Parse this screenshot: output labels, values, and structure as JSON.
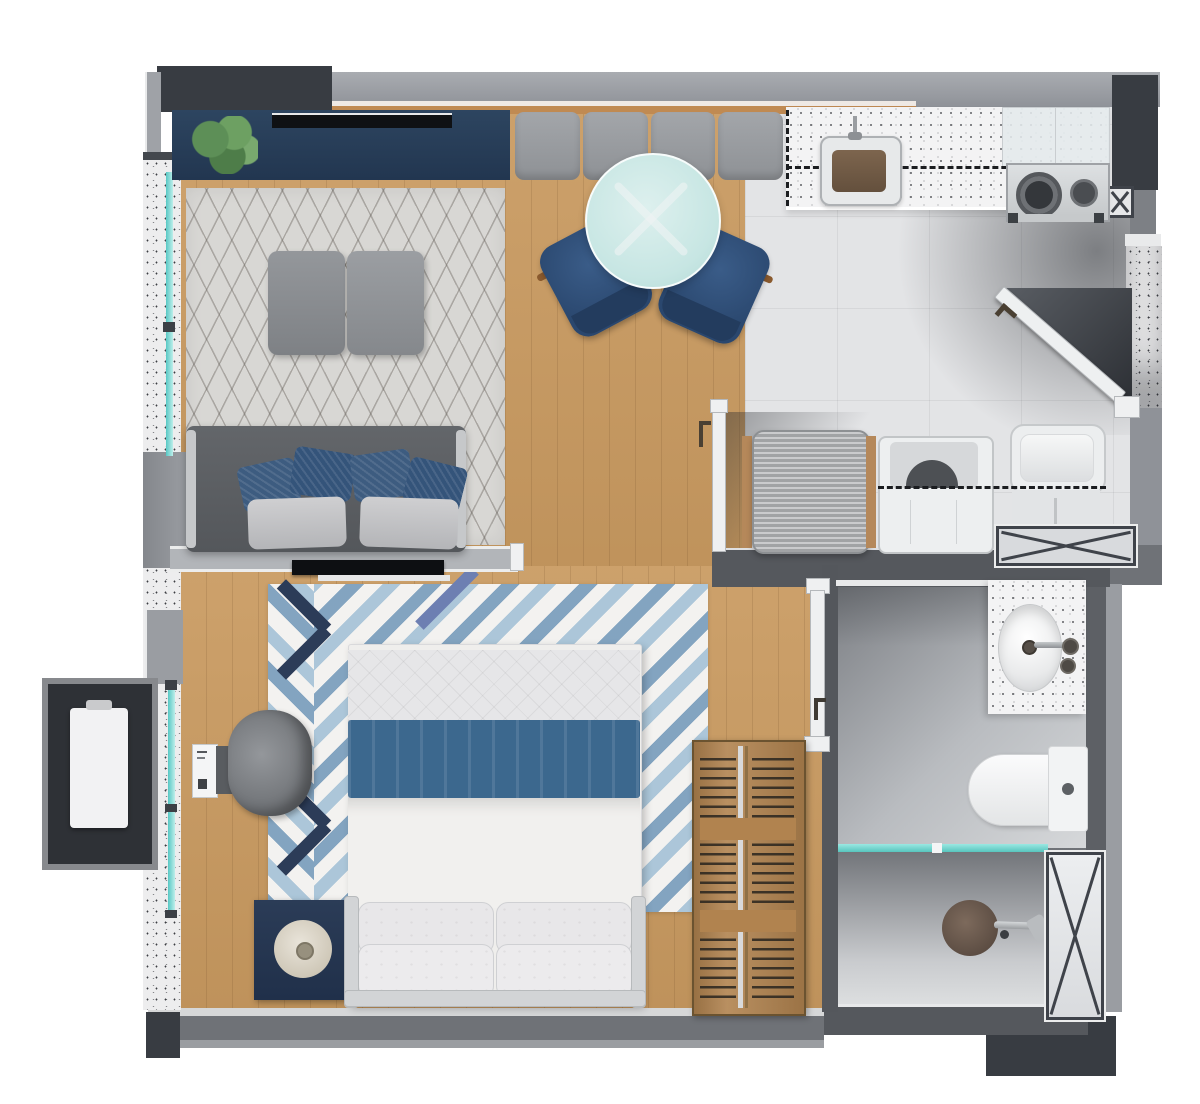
{
  "meta": {
    "title": "Top-down 3D floor plan render of a studio apartment",
    "canvas": {
      "width": 1200,
      "height": 1104
    },
    "visible_text": "none"
  },
  "palette": {
    "wall": "#8f9298",
    "wall_light": "#a9acb1",
    "wall_trim": "#f2f3f4",
    "charcoal": "#383c42",
    "concrete": "#ededee",
    "wood": "#c99a60",
    "wood_dark": "#b1834f",
    "navy": "#2b4058",
    "rug_living": "#d8d7d4",
    "sofa": "#5b5e62",
    "cushion": "#9ea1a5",
    "pillow_navy": "#3d5c80",
    "glass": "#7fd8d2",
    "table": "#cfe9e7",
    "chair_navy": "#30507a",
    "tile": "#e3e4e6",
    "counter": "#f3f3f4",
    "sink_brown": "#6e5743",
    "steel": "#d3d6d8",
    "bed_blue": "#3c688e",
    "rug_blue1": "#7a9dbc",
    "rug_blue2": "#a9c3d6",
    "rug_navy": "#2c3c58",
    "duct": "#3f434a",
    "bath_dark": "#84878c",
    "white": "#f0f1f2"
  },
  "rooms": [
    {
      "id": "living-room",
      "furniture": [
        "navy-console-with-plant",
        "wall-tv",
        "lattice-area-rug",
        "two-ottomans",
        "gray-sofa-with-navy-pillows",
        "window-wall"
      ]
    },
    {
      "id": "dining-area",
      "furniture": [
        "banquette-bench-4-cushions",
        "round-glass-table",
        "two-navy-chairs",
        "wood-floor"
      ]
    },
    {
      "id": "kitchen",
      "furniture": [
        "speckled-counter",
        "sink-with-faucet",
        "gas-cooktop",
        "dashed-upper-cabinets",
        "tile-floor"
      ]
    },
    {
      "id": "entry",
      "furniture": [
        "open-entry-door-diagonal",
        "concrete-column",
        "small-x-duct"
      ]
    },
    {
      "id": "laundry-area",
      "furniture": [
        "ribbed-cabinet",
        "washer",
        "utility-sink",
        "x-brace-duct-horizontal"
      ]
    },
    {
      "id": "bedroom",
      "furniture": [
        "double-bed-blue-blanket",
        "chevron-rug",
        "navy-nightstand-with-lamp",
        "barrel-chair",
        "wall-tv",
        "ac-indoor-unit",
        "open-wardrobe-with-hangers"
      ]
    },
    {
      "id": "bathroom",
      "furniture": [
        "vanity-speckled-counter",
        "oval-sink",
        "toilet",
        "glass-shower-partition",
        "shower-drain-and-mixer",
        "x-brace-duct-vertical"
      ]
    },
    {
      "id": "exterior",
      "furniture": [
        "ac-condenser-platform",
        "teal-window-strips"
      ]
    }
  ]
}
